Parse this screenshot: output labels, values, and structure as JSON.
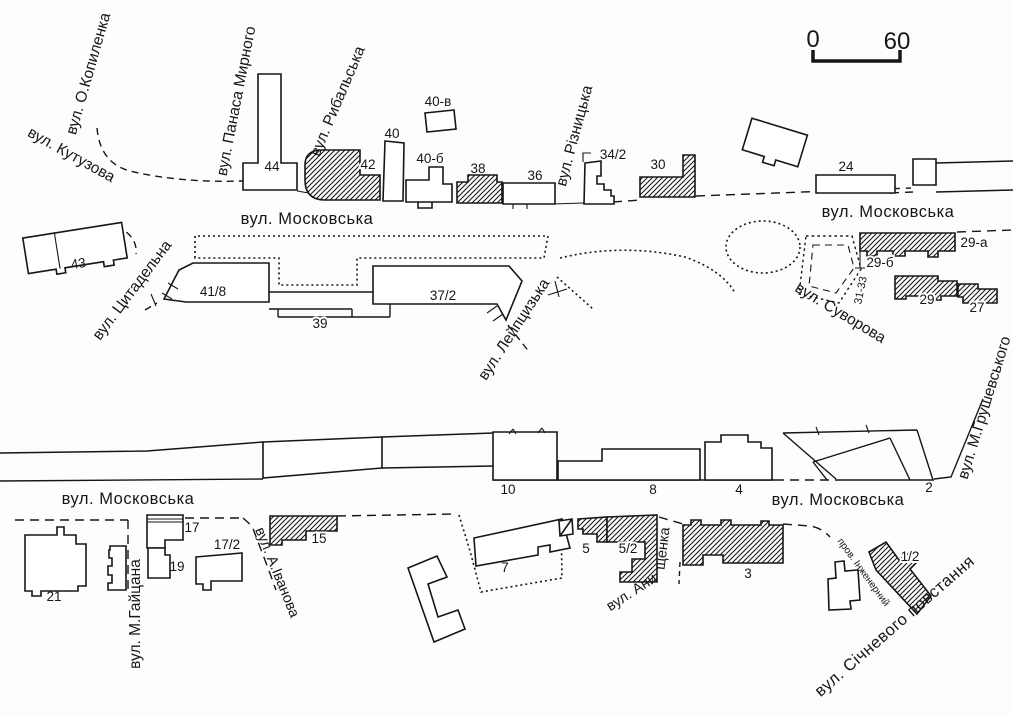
{
  "scale_bar": {
    "start": "0",
    "end": "60"
  },
  "streets": {
    "kopylenka": "вул. О.Копиленка",
    "kutuzova": "вул. Кутузова",
    "panasa_myrnoho": "вул. Панаса Мирного",
    "rybalska": "вул. Рибальська",
    "riznytska": "вул. Різницька",
    "moskovska": "вул. Московська",
    "tsytadelna": "вул. Цитадельна",
    "leiptsyzka": "вул. Лейпцизька",
    "suvorova": "вул. Суворова",
    "hrushevskoho": "вул. М.Грушевського",
    "haitsana": "вул. М.Гайцана",
    "ivanova": "вул. А.Іванова",
    "anyshchenka_1": "вул. Ани",
    "anyshchenka_2": "щенка",
    "inzhenernyi": "пров. Інженерний",
    "sichnevoho": "вул. Січневого  повстання"
  },
  "buildings": {
    "b44": "44",
    "b42": "42",
    "b40": "40",
    "b40v": "40-в",
    "b40b": "40-б",
    "b38": "38",
    "b36": "36",
    "b34_2": "34/2",
    "b30": "30",
    "b24": "24",
    "b43": "43",
    "b41_8": "41/8",
    "b39": "39",
    "b37_2": "37/2",
    "b29a": "29-а",
    "b29b": "29-б",
    "b31_33": "31-33",
    "b29": "29",
    "b27": "27",
    "b10": "10",
    "b8": "8",
    "b4": "4",
    "b2": "2",
    "b21": "21",
    "b17": "17",
    "b19": "19",
    "b17_2": "17/2",
    "b15": "15",
    "b7": "7",
    "b5": "5",
    "b5_2": "5/2",
    "b3": "3",
    "b1_2": "1/2"
  }
}
